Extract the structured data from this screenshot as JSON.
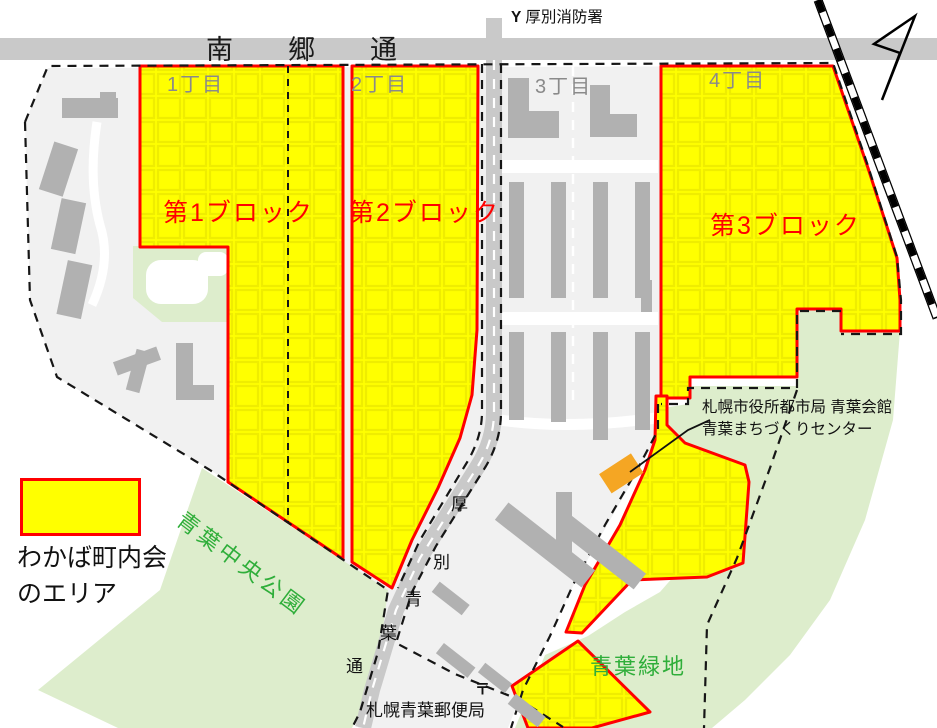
{
  "map": {
    "fire_station": {
      "symbol": "Y",
      "label": "厚別消防署"
    },
    "main_road": "南郷通",
    "districts": [
      "1丁目",
      "2丁目",
      "3丁目",
      "4丁目"
    ],
    "blocks": [
      "第1ブロック",
      "第2ブロック",
      "第3ブロック"
    ],
    "legend": {
      "line1": "わかば町内会",
      "line2": "のエリア"
    },
    "central_park": "青葉中央公園",
    "green_space": "青葉緑地",
    "diagonal_road_chars": [
      "厚",
      "別",
      "青",
      "葉",
      "通"
    ],
    "annotation": {
      "line1": "札幌市役所都市局 青葉会館",
      "line2": "青葉まちづくりセンター"
    },
    "post_office": {
      "symbol": "〒",
      "label": "札幌青葉郵便局"
    },
    "colors": {
      "block_fill": "#ffff00",
      "block_border": "#ff0000",
      "road_gray": "#c9c9c9",
      "urban_gray": "#f1f1f1",
      "park_green": "#ddedcc",
      "building_gray": "#b1b1b1",
      "center_building_orange": "#f5a623",
      "district_text": "#8a8a8a",
      "park_text": "#2fae3a"
    }
  }
}
